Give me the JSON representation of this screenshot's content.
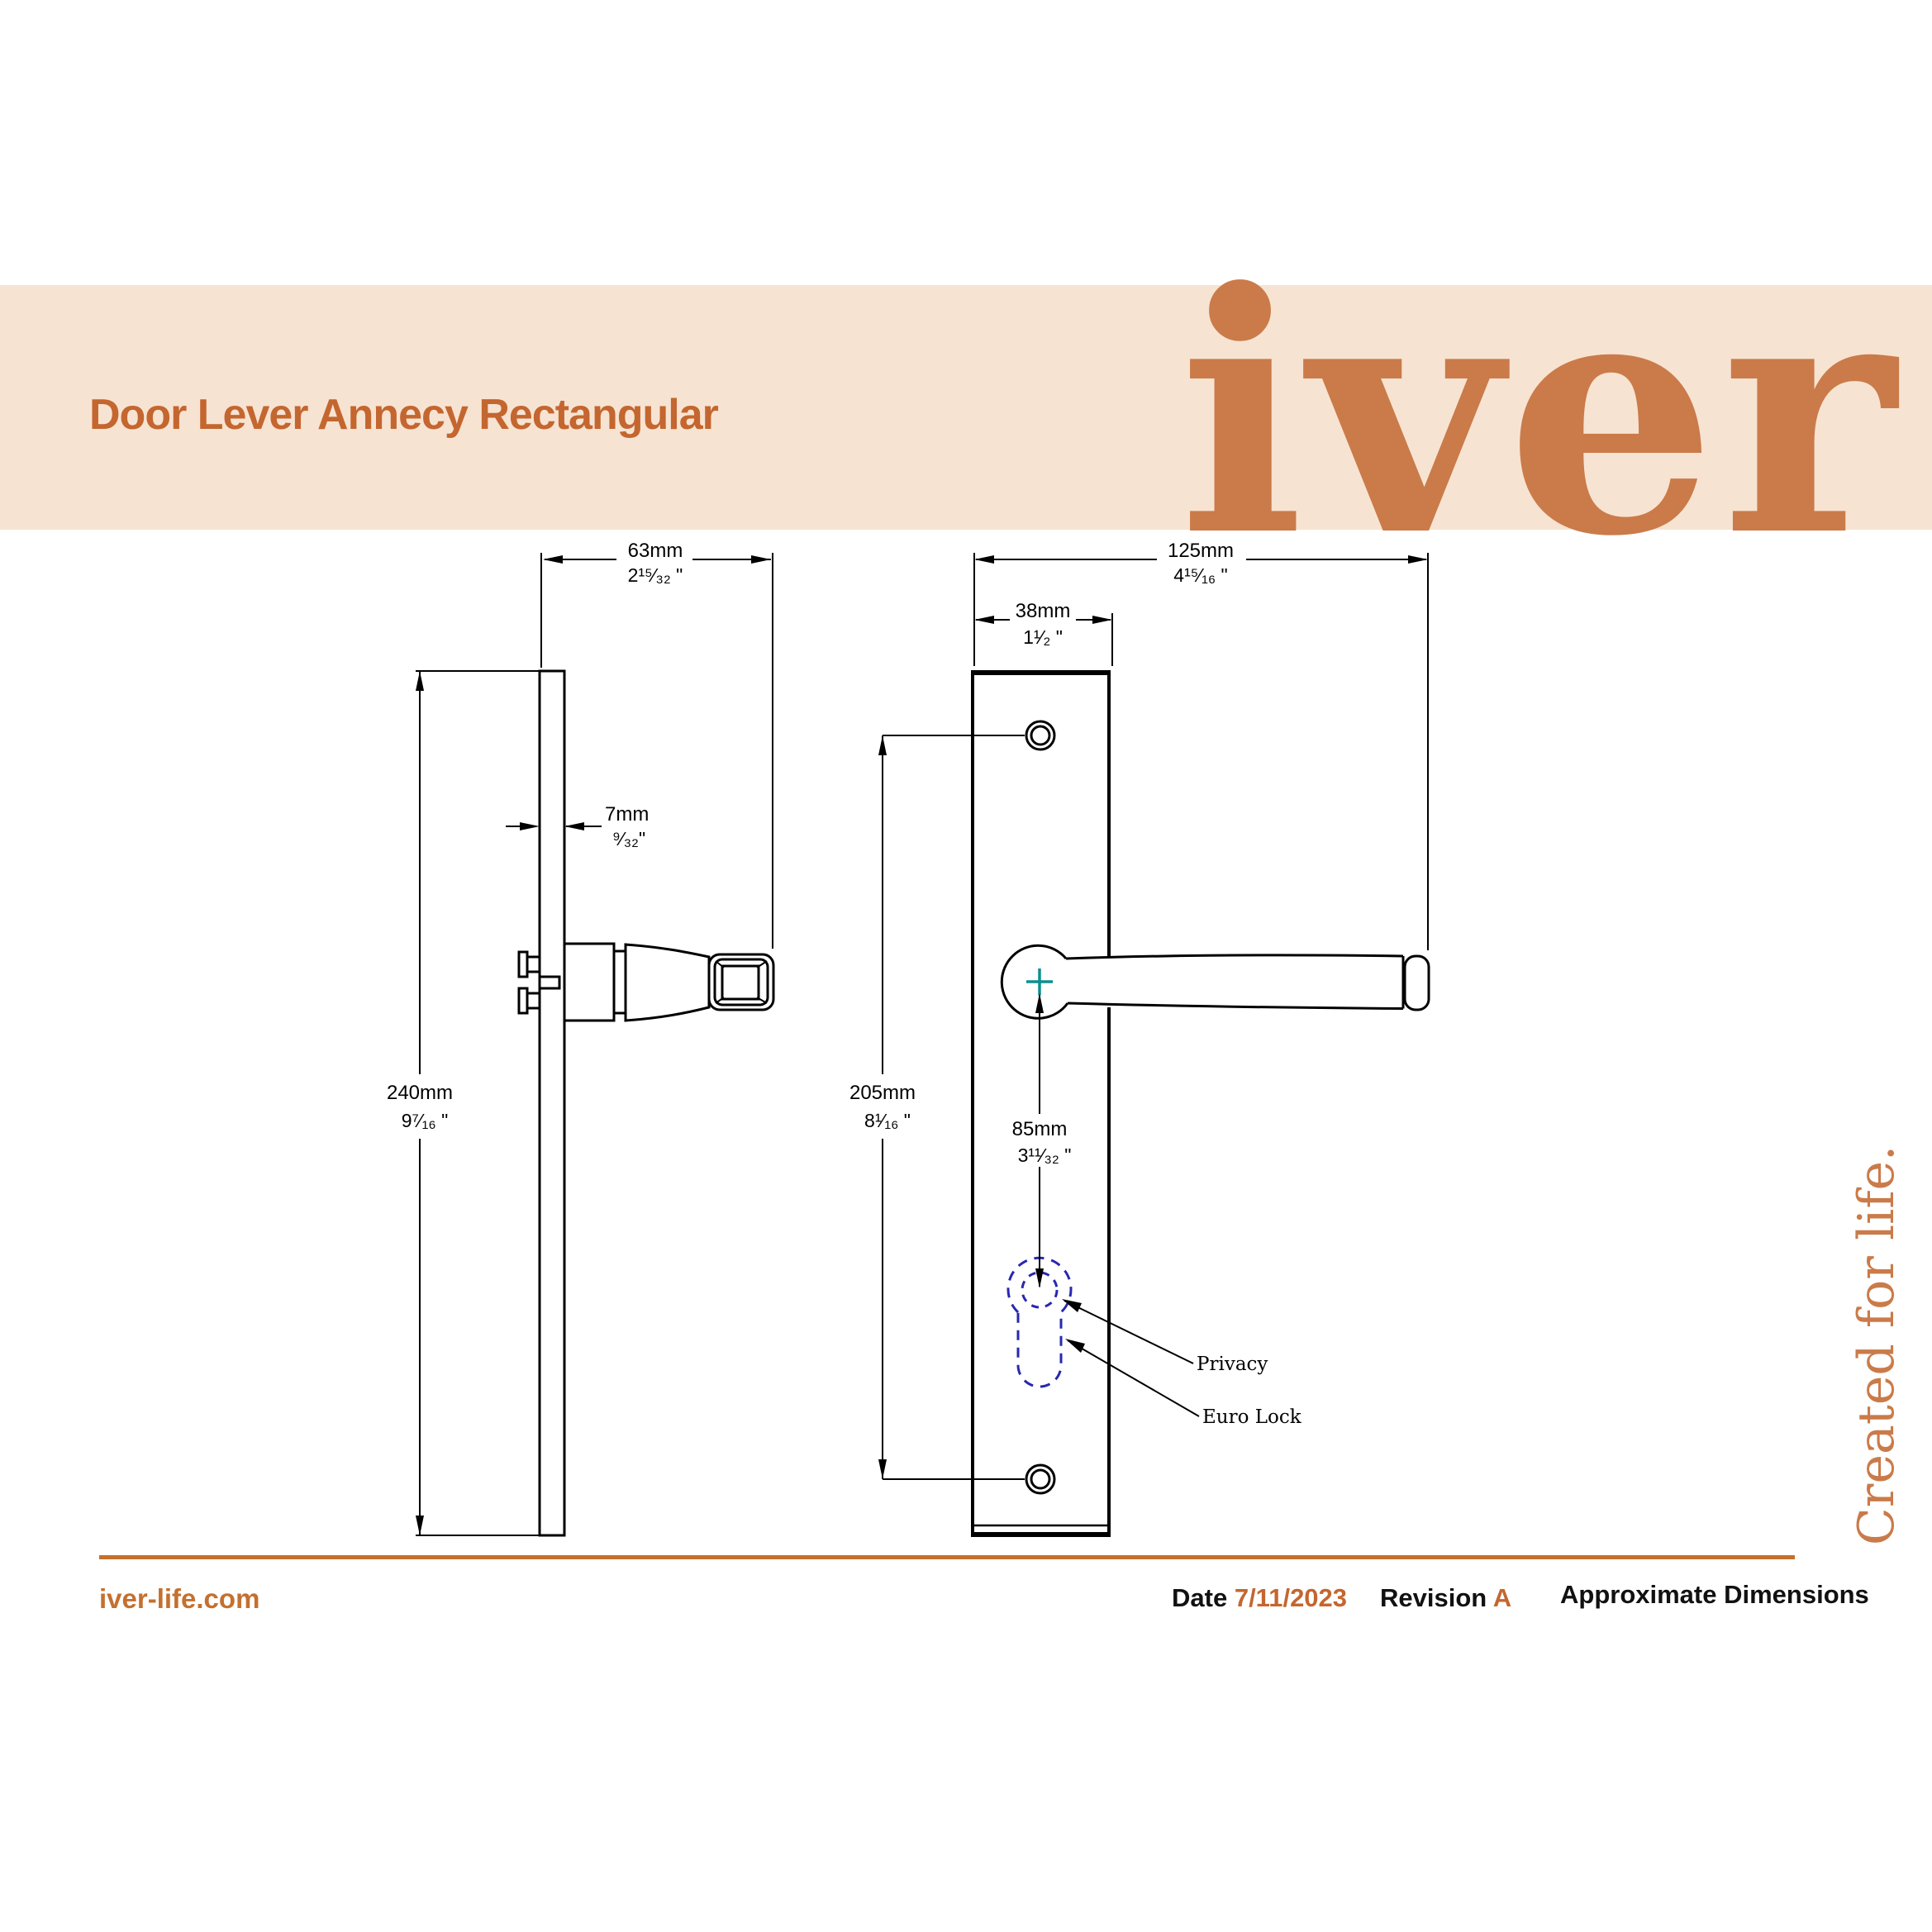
{
  "header": {
    "title": "Door Lever Annecy Rectangular",
    "logo": "iver"
  },
  "side_view": {
    "projection": {
      "mm": "63mm",
      "inch": "2¹⁵⁄₃₂ \""
    },
    "plate_thickness": {
      "mm": "7mm",
      "inch": "⁹⁄₃₂\""
    },
    "plate_height": {
      "mm": "240mm",
      "inch": "9⁷⁄₁₆ \""
    }
  },
  "front_view": {
    "total_width": {
      "mm": "125mm",
      "inch": "4¹⁵⁄₁₆ \""
    },
    "plate_width": {
      "mm": "38mm",
      "inch": "1¹⁄₂ \""
    },
    "hole_spacing": {
      "mm": "205mm",
      "inch": "8¹⁄₁₆ \""
    },
    "lock_centre_distance": {
      "mm": "85mm",
      "inch": "3¹¹⁄₃₂ \""
    },
    "callouts": {
      "privacy": "Privacy",
      "euro_lock": "Euro Lock"
    }
  },
  "tagline": "Created for life.",
  "footer": {
    "website": "iver-life.com",
    "date_label": "Date",
    "date_value": "7/11/2023",
    "revision_label": "Revision",
    "revision_value": "A",
    "note": "Approximate Dimensions"
  },
  "colors": {
    "band_background": "#f7e3d2",
    "accent_orange": "#c4662f",
    "logo_orange": "#ca7b49",
    "rule_orange": "#c4702f",
    "keyhole_dashed_blue": "#2828b0",
    "center_mark_teal": "#0e8f8f",
    "drawing_line": "#000000"
  }
}
